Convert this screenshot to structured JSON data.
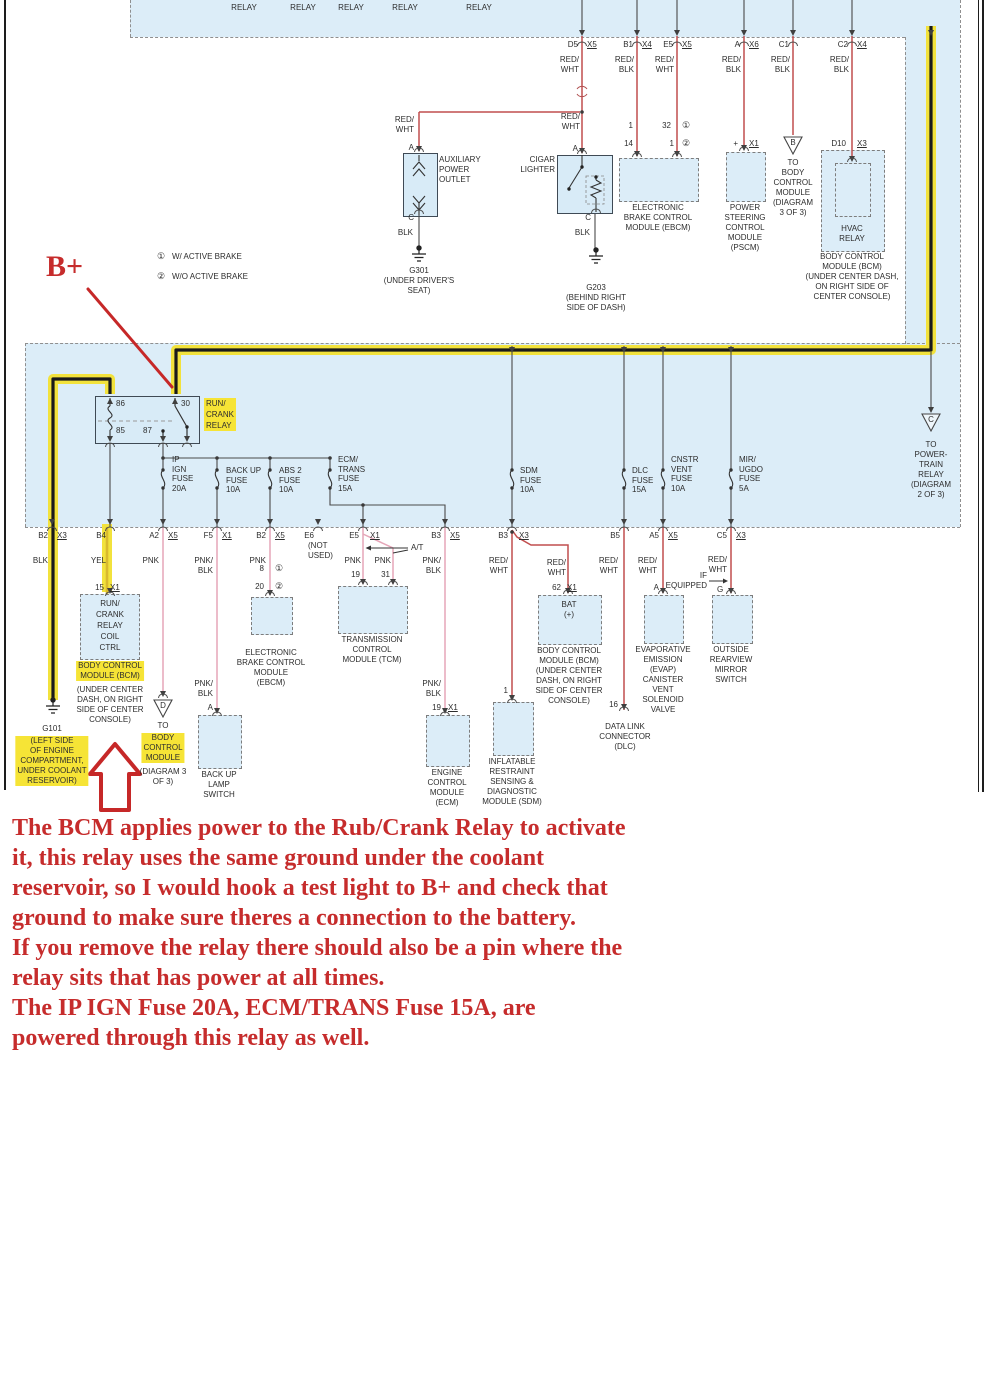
{
  "colors": {
    "highlight": "#f6e436",
    "blue_fill": "#dcedf8",
    "wire_red": "#c14f4f",
    "wire_pink": "#e5a6b8",
    "wire_yellow": "#d9b92e",
    "annotation_red": "#c62c2c"
  },
  "strip": {
    "labels": [
      "RELAY",
      "DEFOG\nRELAY",
      "ON/OFF\nRELAY",
      "LO/HI\nRELAY",
      "FAN 1\nRELAY",
      "FAN 2\nRELAY",
      "RELAY"
    ]
  },
  "top": {
    "conns": [
      {
        "pin": "D5",
        "x": "X5",
        "wire": "RED/\nWHT"
      },
      {
        "pin": "B1",
        "x": "X4",
        "wire": "RED/\nBLK"
      },
      {
        "pin": "E5",
        "x": "X5",
        "wire": "RED/\nWHT"
      },
      {
        "pin": "A",
        "x": "X6",
        "wire": "RED/\nBLK"
      },
      {
        "pin": "C1",
        "x": "",
        "wire": "RED/\nBLK"
      },
      {
        "pin": "C2",
        "x": "X4",
        "wire": "RED/\nBLK"
      }
    ],
    "aux": {
      "wire": "RED/\nWHT",
      "pin_in": "A",
      "label": "AUXILIARY\nPOWER\nOUTLET",
      "pin_out": "C",
      "wire_out": "BLK",
      "ground": "G301\n(UNDER DRIVER'S\nSEAT)"
    },
    "cigar": {
      "wire": "RED/\nWHT",
      "pin_in": "A",
      "name": "CIGAR\nLIGHTER",
      "pin_out": "C",
      "wire_out": "BLK",
      "ground": "G203\n(BEHIND RIGHT\nSIDE OF DASH)"
    },
    "ebcm": {
      "p1": "1",
      "p14": "14",
      "p32": "32",
      "p1b": "1",
      "f1": "①",
      "f2": "②",
      "label": "ELECTRONIC\nBRAKE CONTROL\nMODULE (EBCM)"
    },
    "pscm": {
      "pin": "+",
      "x": "X1",
      "label": "POWER\nSTEERING\nCONTROL\nMODULE\n(PSCM)"
    },
    "refB": {
      "letter": "B",
      "label": "TO\nBODY\nCONTROL\nMODULE\n(DIAGRAM\n3 OF 3)"
    },
    "hvac": {
      "pin": "D10",
      "x": "X3",
      "relay": "HVAC\nRELAY",
      "bcm": "BODY CONTROL\nMODULE (BCM)\n(UNDER CENTER DASH,\nON RIGHT SIDE OF\nCENTER CONSOLE)"
    },
    "legend": [
      {
        "s": "①",
        "t": "W/ ACTIVE BRAKE"
      },
      {
        "s": "②",
        "t": "W/O ACTIVE BRAKE"
      }
    ]
  },
  "band": {
    "relay": {
      "p86": "86",
      "p30": "30",
      "p85": "85",
      "p87": "87",
      "name": "RUN/\nCRANK\nRELAY"
    },
    "fuses": [
      "IP\nIGN\nFUSE\n20A",
      "BACK UP\nFUSE\n10A",
      "ABS 2\nFUSE\n10A",
      "ECM/\nTRANS\nFUSE\n15A",
      "SDM\nFUSE\n10A",
      "DLC\nFUSE\n15A",
      "CNSTR\nVENT\nFUSE\n10A",
      "MIR/\nUGDO\nFUSE\n5A"
    ],
    "refC": {
      "letter": "C",
      "label": "TO\nPOWER-\nTRAIN\nRELAY\n(DIAGRAM\n2 OF 3)"
    }
  },
  "out": {
    "conns": [
      {
        "pin": "B2",
        "x": "X3"
      },
      {
        "pin": "B4",
        "x": ""
      },
      {
        "pin": "A2",
        "x": "X5"
      },
      {
        "pin": "F5",
        "x": "X1"
      },
      {
        "pin": "B2",
        "x": "X5"
      },
      {
        "pin": "E6",
        "x": ""
      },
      {
        "pin": "E5",
        "x": "X1"
      },
      {
        "pin": "B3",
        "x": "X5"
      },
      {
        "pin": "B3",
        "x": "X3"
      },
      {
        "pin": "B5",
        "x": ""
      },
      {
        "pin": "A5",
        "x": "X5"
      },
      {
        "pin": "C5",
        "x": "X3"
      }
    ],
    "not_used": "(NOT\nUSED)",
    "w_blk": "BLK",
    "w_yel": "YEL",
    "w_pnk_a2": "PNK",
    "w_pnkblk_f5": "PNK/\nBLK",
    "w_pnk_b2": "PNK",
    "w_pnk_e5a": "PNK",
    "w_pnk_e5b": "PNK",
    "at": "A/T",
    "w_pnkblk_b3": "PNK/\nBLK",
    "w_rw_sdm": "RED/\nWHT",
    "w_rw_bat": "RED/\nWHT",
    "w_rw_b5": "RED/\nWHT",
    "w_rw_a5": "RED/\nWHT",
    "w_rw_c5": "RED/\nWHT",
    "if_eq": "IF\nEQUIPPED",
    "w_pnkblk_f5b": "PNK/\nBLK",
    "w_pnkblk_b3b": "PNK/\nBLK",
    "g101": {
      "name": "G101",
      "loc": "(LEFT SIDE\nOF ENGINE\nCOMPARTMENT,\nUNDER COOLANT\nRESERVOIR)"
    },
    "coil": {
      "p15": "15",
      "x": "X1",
      "box": "RUN/\nCRANK\nRELAY\nCOIL\nCTRL",
      "bcm_hl": "BODY CONTROL\nMODULE (BCM)",
      "bcm_rest": "(UNDER CENTER\nDASH, ON RIGHT\nSIDE OF CENTER\nCONSOLE)"
    },
    "refD": {
      "letter": "D",
      "to": "TO",
      "hl": "BODY\nCONTROL\nMODULE",
      "rest": "(DIAGRAM 3\nOF 3)"
    },
    "backup": {
      "pin": "A",
      "label": "BACK UP\nLAMP\nSWITCH"
    },
    "ebcm": {
      "p8": "8",
      "p20": "20",
      "f1": "①",
      "f2": "②",
      "label": "ELECTRONIC\nBRAKE CONTROL\nMODULE\n(EBCM)"
    },
    "tcm": {
      "p19": "19",
      "p31": "31",
      "label": "TRANSMISSION\nCONTROL\nMODULE (TCM)"
    },
    "ecm": {
      "p19": "19",
      "x": "X1",
      "label": "ENGINE\nCONTROL\nMODULE\n(ECM)"
    },
    "sdm": {
      "p1": "1",
      "label": "INFLATABLE\nRESTRAINT\nSENSING &\nDIAGNOSTIC\nMODULE (SDM)"
    },
    "bat": {
      "p62": "62",
      "x": "X1",
      "box": "BAT\n(+)",
      "label": "BODY CONTROL\nMODULE (BCM)\n(UNDER CENTER\nDASH, ON RIGHT\nSIDE OF CENTER\nCONSOLE)"
    },
    "dlc": {
      "p16": "16",
      "label": "DATA LINK\nCONNECTOR\n(DLC)"
    },
    "evap": {
      "pin": "A",
      "label": "EVAPORATIVE\nEMISSION\n(EVAP)\nCANISTER\nVENT\nSOLENOID\nVALVE"
    },
    "mirror": {
      "pin": "G",
      "label": "OUTSIDE\nREARVIEW\nMIRROR\nSWITCH"
    }
  },
  "notes": {
    "bplus": "B+",
    "lines": [
      "The BCM applies power to the Rub/Crank Relay to activate",
      "it, this relay uses the same ground under the coolant",
      "reservoir, so I would hook a test light to B+ and check that",
      "ground to make sure theres a connection to the battery.",
      "If you remove the relay there should also be a pin where the",
      "relay sits that has power at all times.",
      "The IP IGN Fuse 20A, ECM/TRANS Fuse 15A, are",
      "powered through this relay as well."
    ]
  }
}
